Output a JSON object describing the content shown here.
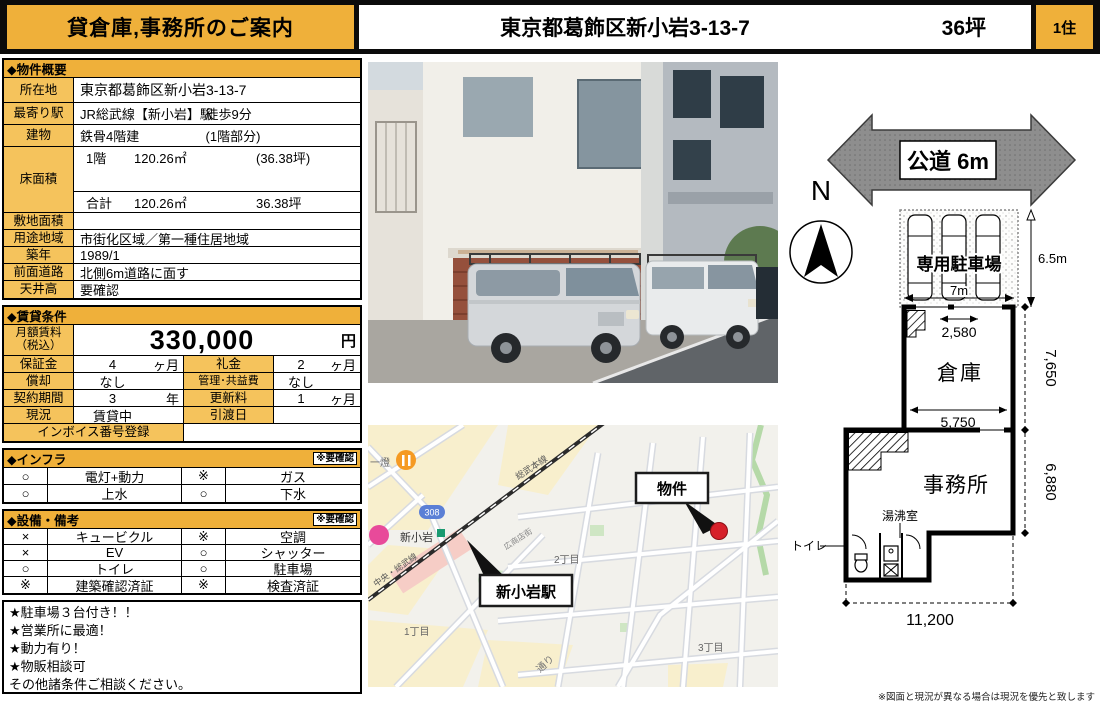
{
  "colors": {
    "accent": "#EFB03A",
    "accent_light": "#F5C35C",
    "map_dot_red": "#D6202A"
  },
  "header": {
    "title": "貸倉庫,事務所のご案内",
    "address": "東京都葛飾区新小岩3-13-7",
    "area": "36坪",
    "badge": "1住"
  },
  "overview": {
    "title": "◆物件概要",
    "location_label": "所在地",
    "location": "東京都葛飾区新小岩3-13-7",
    "station_label": "最寄り駅",
    "station": "JR総武線【新小岩】駅",
    "walk": "徒歩9分",
    "building_label": "建物",
    "building": "鉄骨4階建",
    "building_note": "(1階部分)",
    "floor_label": "床面積",
    "floor_row1": {
      "name": "1階",
      "sqm": "120.26㎡",
      "tsubo": "(36.38坪)"
    },
    "floor_total": {
      "name": "合計",
      "sqm": "120.26㎡",
      "tsubo": "36.38坪"
    },
    "land_label": "敷地面積",
    "land": "",
    "zoning_label": "用途地域",
    "zoning": "市街化区域／第一種住居地域",
    "built_label": "築年",
    "built": "1989/1",
    "front_road_label": "前面道路",
    "front_road": "北側6m道路に面す",
    "ceiling_label": "天井高",
    "ceiling": "要確認"
  },
  "rent": {
    "title": "◆賃貸条件",
    "monthly_label": "月額賃料",
    "monthly_label2": "（税込）",
    "amount": "330,000",
    "unit": "円",
    "rows": [
      {
        "l1": "保証金",
        "v1": "4",
        "u1": "ヶ月",
        "l2": "礼金",
        "v2": "2",
        "u2": "ヶ月"
      },
      {
        "l1": "償却",
        "v1": "なし",
        "u1": "",
        "l2": "管理･共益費",
        "v2": "なし",
        "u2": ""
      },
      {
        "l1": "契約期間",
        "v1": "3",
        "u1": "年",
        "l2": "更新料",
        "v2": "1",
        "u2": "ヶ月"
      },
      {
        "l1": "現況",
        "v1": "賃貸中",
        "u1": "",
        "l2": "引渡日",
        "v2": "",
        "u2": ""
      }
    ],
    "invoice_label": "インボイス番号登録",
    "invoice_value": ""
  },
  "infra": {
    "title": "◆インフラ",
    "note": "※要確認",
    "rows": [
      {
        "m1": "○",
        "l1": "電灯+動力",
        "m2": "※",
        "l2": "ガス"
      },
      {
        "m1": "○",
        "l1": "上水",
        "m2": "○",
        "l2": "下水"
      }
    ]
  },
  "equip": {
    "title": "◆設備・備考",
    "note": "※要確認",
    "rows": [
      {
        "m1": "×",
        "l1": "キュービクル",
        "m2": "※",
        "l2": "空調"
      },
      {
        "m1": "×",
        "l1": "EV",
        "m2": "○",
        "l2": "シャッター"
      },
      {
        "m1": "○",
        "l1": "トイレ",
        "m2": "○",
        "l2": "駐車場"
      },
      {
        "m1": "※",
        "l1": "建築確認済証",
        "m2": "※",
        "l2": "検査済証"
      }
    ]
  },
  "notes": {
    "lines": [
      "★駐車場３台付き！！",
      "★営業所に最適！",
      "★動力有り！",
      "★物販相談可",
      "その他諸条件ご相談ください。"
    ]
  },
  "map": {
    "poi_izakaya": "一燈",
    "route_badge": "308",
    "station_name": "新小岩",
    "rail_main": "総武本線",
    "rail_chuo": "中央・総武線",
    "shopping_street": "広商店街",
    "district_1": "1丁目",
    "district_2": "2丁目",
    "district_3": "3丁目",
    "road_name": "通り",
    "callout_station": "新小岩駅",
    "callout_property": "物件"
  },
  "plan": {
    "road_label": "公道 6m",
    "compass": "N",
    "parking_label": "専用駐車場",
    "parking_width": "7m",
    "parking_depth": "6.5m",
    "dim_2580": "2,580",
    "warehouse_label": "倉庫",
    "dim_5750": "5,750",
    "office_label": "事務所",
    "kitchen_label": "湯沸室",
    "toilet_label": "トイレ",
    "dim_7650": "7,650",
    "dim_6880": "6,880",
    "dim_11200": "11,200"
  },
  "footer": {
    "disclaimer": "※図面と現況が異なる場合は現況を優先と致します"
  }
}
